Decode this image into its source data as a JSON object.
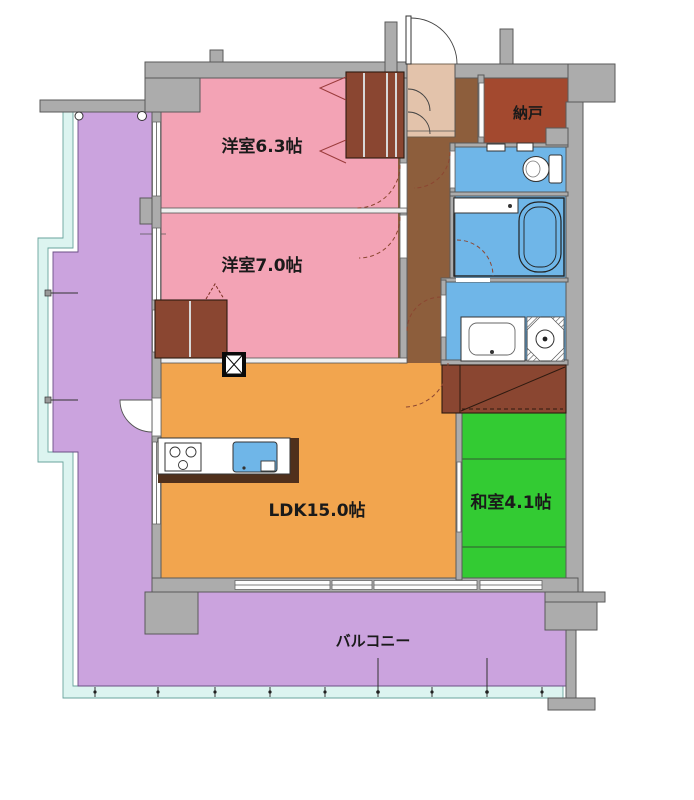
{
  "plan": {
    "type": "apartment-floor-plan",
    "rooms": {
      "western1": {
        "label": "洋室6.3帖"
      },
      "western2": {
        "label": "洋室7.0帖"
      },
      "ldk": {
        "label": "LDK15.0帖"
      },
      "japanese": {
        "label": "和室4.1帖"
      },
      "storage": {
        "label": "納戸"
      },
      "balcony": {
        "label": "バルコニー"
      }
    },
    "fixtures": [
      "entrance-door",
      "shoe-cabinet",
      "toilet",
      "bathtub",
      "bath-counter",
      "vanity-sink",
      "washing-machine",
      "gas-stove",
      "kitchen-sink",
      "closet",
      "futon-closet",
      "pillar-shaft",
      "balcony-railing"
    ]
  },
  "colors": {
    "wall": "#ACACAC",
    "wallline": "#5A5A5A",
    "pink": "#F3A3B5",
    "orange": "#F2A54E",
    "green": "#33CB33",
    "purple": "#CBA3DE",
    "blue": "#6FB6E8",
    "hall": "#8D5E3C",
    "closet": "#8A4631",
    "storage": "#A3492F",
    "entry": "#E3C3AB",
    "mint": "#DCF4F0",
    "counter": "#50301C",
    "ink": "#1A1A1A"
  }
}
